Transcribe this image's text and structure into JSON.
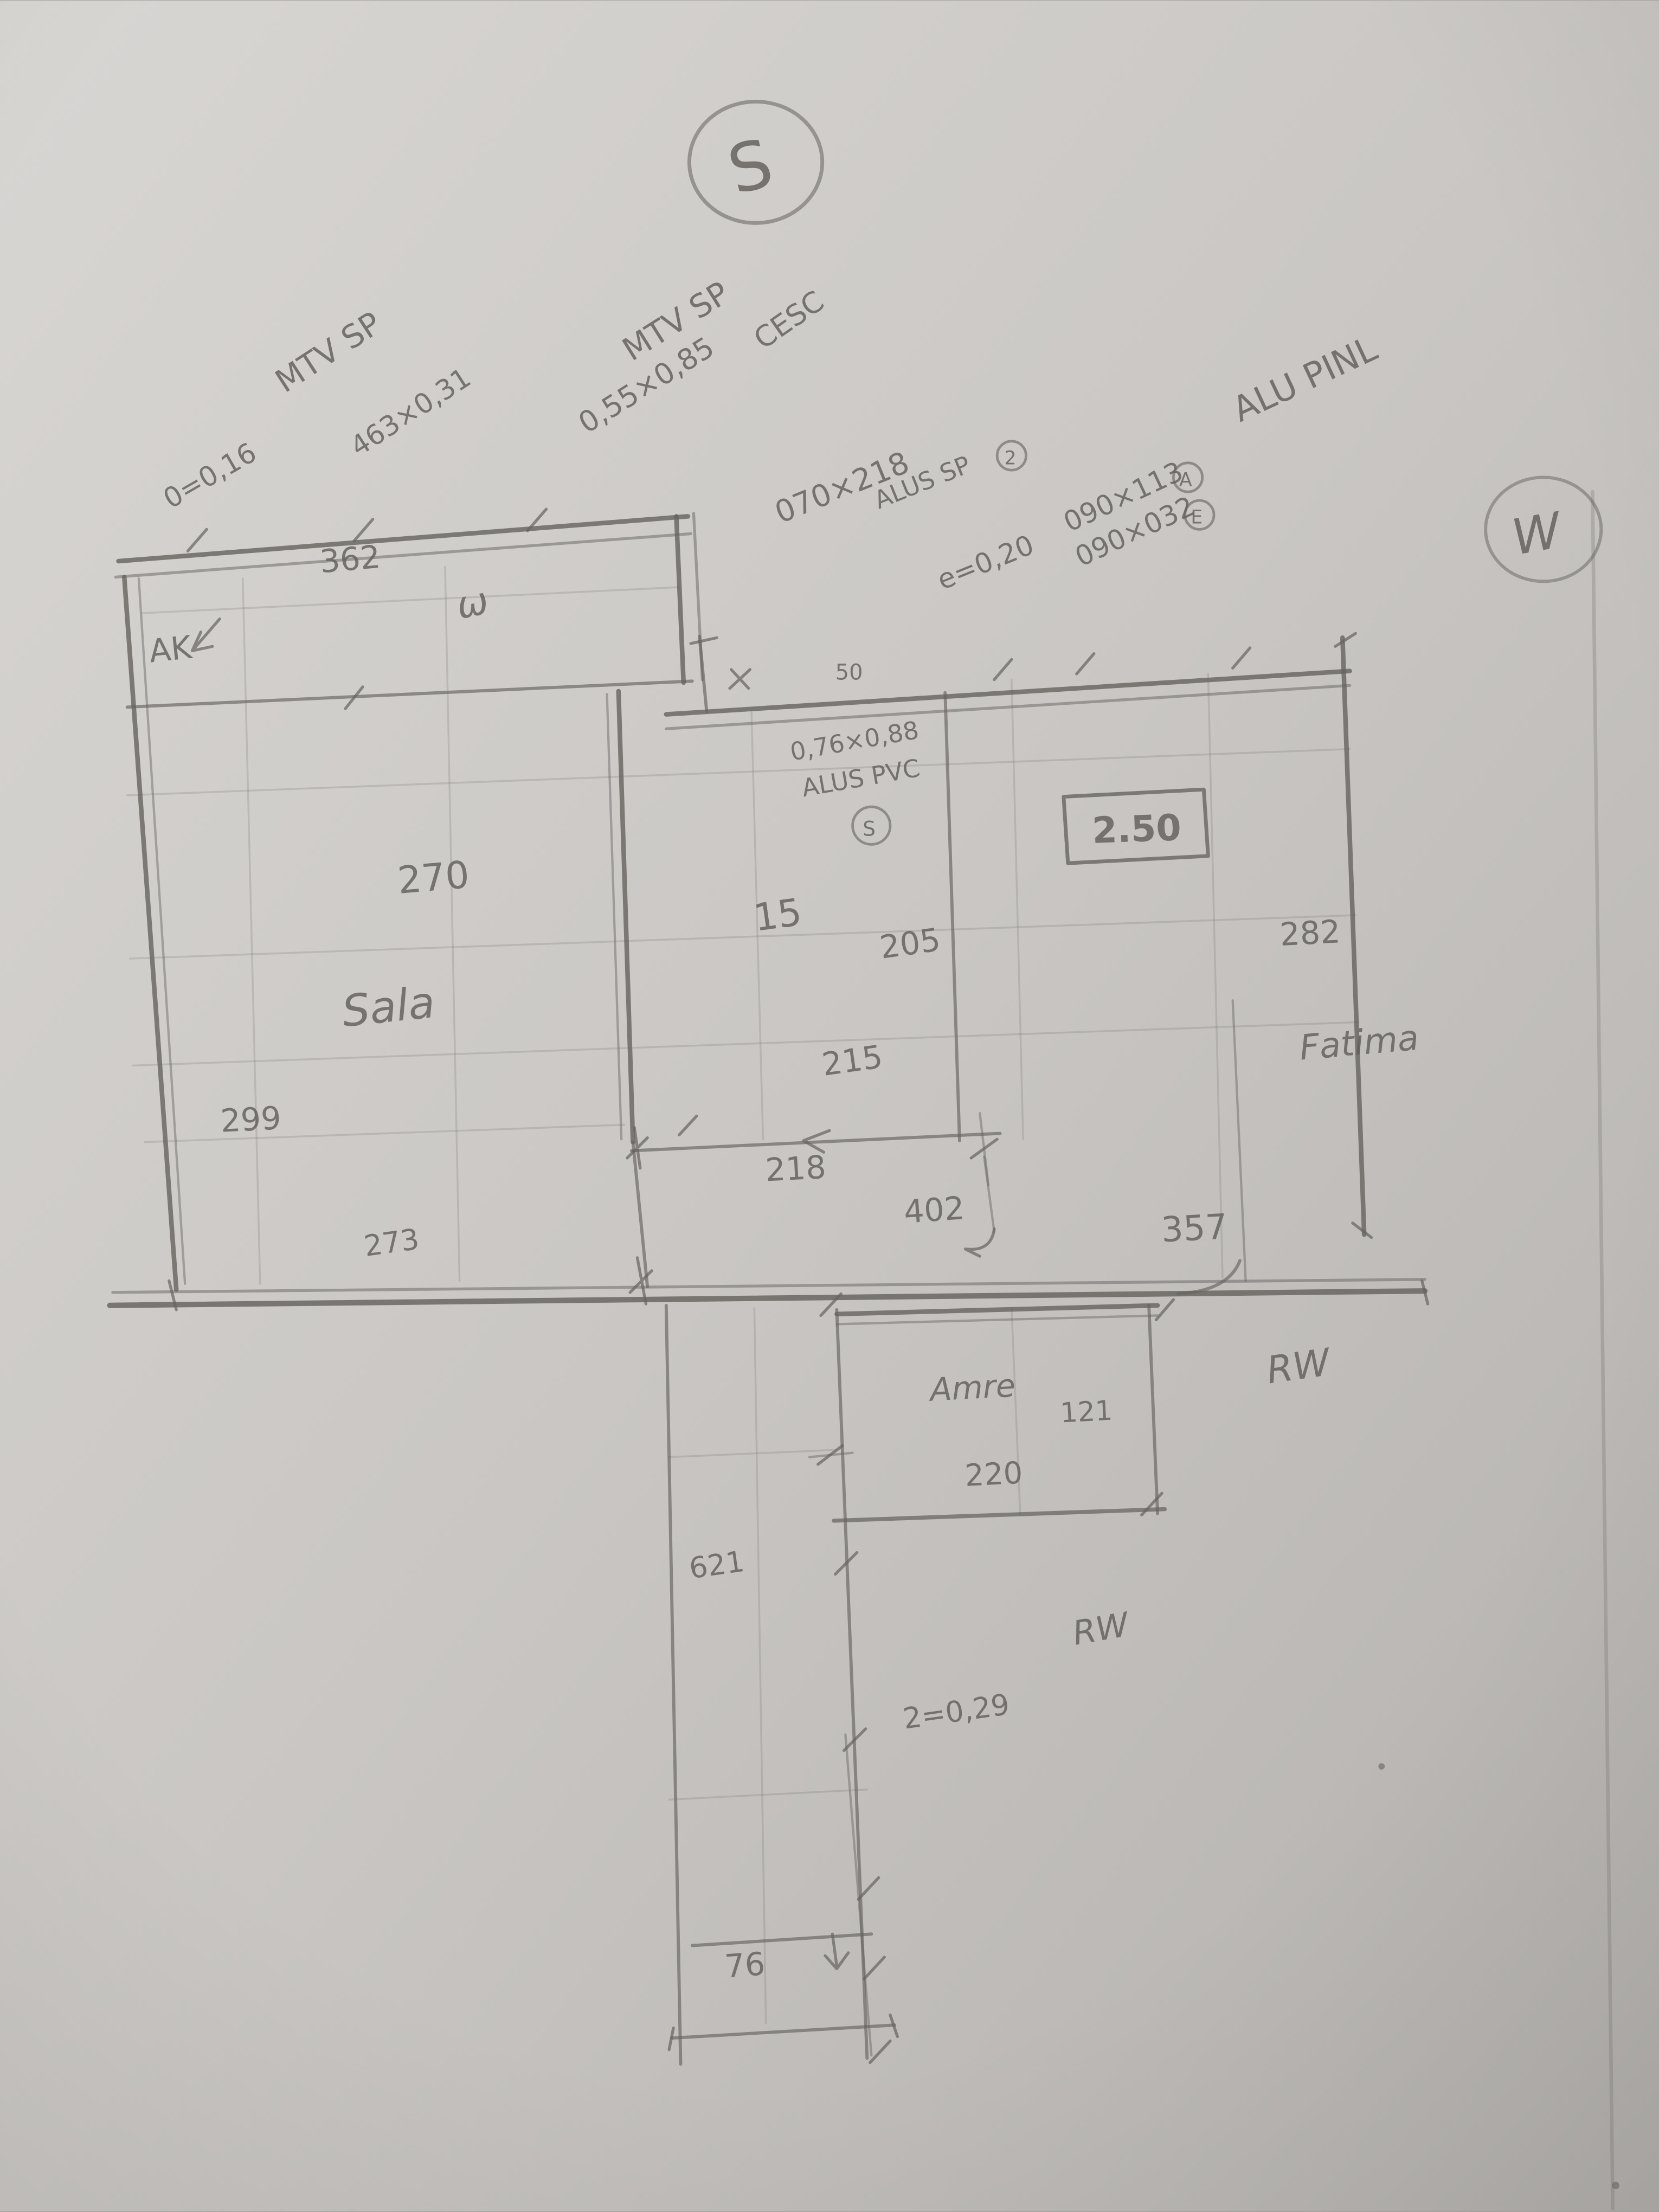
{
  "sketch": {
    "type": "hand-drawn floor plan, pencil on paper",
    "compass": {
      "south": "S",
      "west": "W"
    },
    "colors": {
      "paper_light": "#d8d6d3",
      "paper_dark": "#b3b0ad",
      "pencil": "#66635f"
    }
  },
  "texts": {
    "compass_s": "S",
    "compass_w": "W",
    "note_mtv_sp_1": "MTV SP",
    "note_dim_1": "463×0,31",
    "note_e016": "0=0,16",
    "note_mtv_sp_2": "MTV SP",
    "note_dim_2": "0,55×0,85",
    "note_cesc": "CESC",
    "note_dim_3": "070×218",
    "note_alus_sp": "ALUS SP",
    "note_alus_sp_mark": "2",
    "note_e020": "e=0,20",
    "note_dim_4": "090×113",
    "note_dim_4_mark": "A",
    "note_dim_5": "090×032",
    "note_dim_5_mark": "E",
    "note_alu_pinl": "ALU PINL",
    "note_dim_6": "0,76×0,88",
    "note_alus_pvc": "ALUS PVC",
    "note_alus_pvc_mark": "S",
    "dim_362": "362",
    "label_ak": "AK",
    "label_w_squiggle": "ω",
    "dim_50": "50",
    "height_250": "2.50",
    "dim_270": "270",
    "room_sala": "Sala",
    "dim_299": "299",
    "dim_273": "273",
    "dim_15": "15",
    "dim_205": "205",
    "dim_215": "215",
    "dim_218": "218",
    "dim_282": "282",
    "dim_402": "402",
    "dim_357": "357",
    "name_fatima": "Fatima",
    "name_rw_1": "RW",
    "name_rw_2": "RW",
    "note_e029": "2=0,29",
    "dim_621": "621",
    "dim_76": "76",
    "room_amre": "Amre",
    "dim_121": "121",
    "dim_220": "220"
  }
}
